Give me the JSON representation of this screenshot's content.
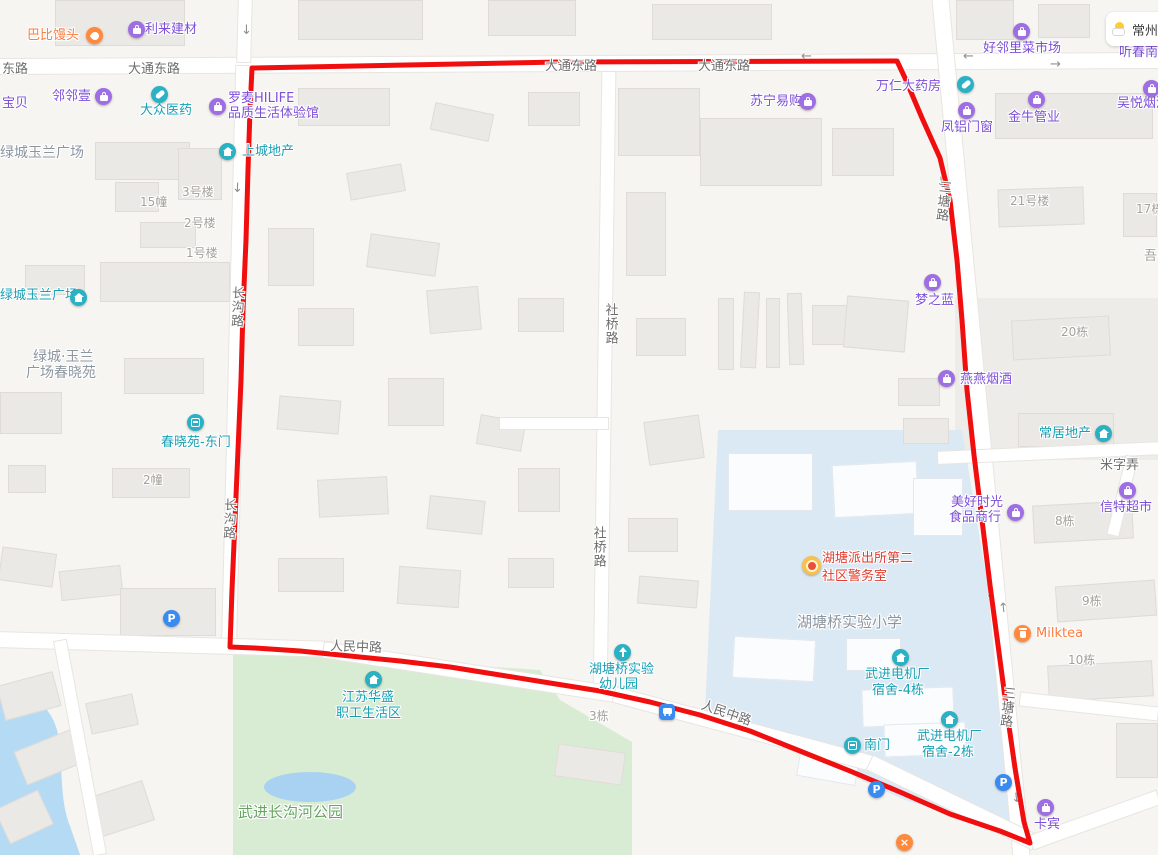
{
  "map": {
    "width": 1158,
    "height": 855
  },
  "colors": {
    "purple": "#7C4FD8",
    "teal": "#17A0B4",
    "orange": "#FF7B3D",
    "red_text": "#E23B2E",
    "gray_label": "#A5A099",
    "area_label": "#8C96A0",
    "green_label": "#67A463",
    "road_label": "#6E6E6E",
    "route_red": "#F10E0E",
    "school_fill": "#DBE9F4",
    "park_fill": "#D8ECD3",
    "water_fill": "#B5DAF4"
  },
  "weather": {
    "city": "常州"
  },
  "route": {
    "color": "#F10E0E",
    "width": 5,
    "points": "252,68 560,62 897,61 905,78 922,118 940,158 950,200 957,260 962,320 967,390 974,455 982,520 990,585 998,645 1006,705 1015,768 1024,822 1030,843 1000,831 950,814 900,792 850,771 800,751 750,731 700,715 650,702 600,691 550,683 500,675 450,667 400,661 350,656 300,651 255,648 230,647 232,590 235,520 238,450 241,380 243,310 246,240 248,170 250,110 252,68"
  },
  "areas": {
    "school": "M718,430 L962,430 L985,570 L1000,680 L1015,790 L1022,836 L905,800 L790,748 L705,712 L712,560 Z",
    "park": "M233,650 L540,670 L560,700 L632,742 L632,855 L233,855 Z",
    "river": "M0,686 C28,690 50,704 57,730 C64,758 58,796 70,826 C74,838 78,848 80,855 L0,855 Z",
    "pond": {
      "cx": 310,
      "cy": 787,
      "rx": 46,
      "ry": 15
    }
  },
  "parcels": [
    [
      955,
      298,
      205,
      162
    ]
  ],
  "roads": [
    [
      -4,
      56,
      1166,
      15,
      -0.3
    ],
    [
      238,
      0,
      13,
      62,
      1.5
    ],
    [
      229,
      66,
      14,
      588,
      1.4
    ],
    [
      598,
      72,
      13,
      622,
      0.8
    ],
    [
      973,
      -6,
      16,
      868,
      -5.4
    ],
    [
      -4,
      637,
      340,
      15,
      1.7
    ],
    [
      322,
      665,
      300,
      15,
      8.7
    ],
    [
      610,
      722,
      270,
      15,
      15
    ],
    [
      861,
      795,
      183,
      15,
      25.9
    ],
    [
      1028,
      813,
      134,
      14,
      -19.7
    ],
    [
      938,
      447,
      222,
      12,
      -2.5
    ],
    [
      1117,
      456,
      11,
      80,
      13.9
    ],
    [
      74,
      639,
      12,
      217,
      -10.6
    ],
    [
      1020,
      700,
      138,
      13,
      6.2
    ],
    [
      500,
      418,
      108,
      11,
      0
    ]
  ],
  "buildings": [
    [
      55,
      0,
      130,
      46,
      0,
      0
    ],
    [
      298,
      0,
      125,
      40,
      0,
      0
    ],
    [
      488,
      0,
      88,
      36,
      0,
      0
    ],
    [
      652,
      4,
      120,
      36,
      0,
      0
    ],
    [
      956,
      0,
      58,
      40,
      0,
      0
    ],
    [
      1038,
      4,
      52,
      34,
      0,
      0
    ],
    [
      95,
      142,
      95,
      38,
      0,
      0
    ],
    [
      178,
      148,
      44,
      52,
      0,
      0
    ],
    [
      115,
      182,
      44,
      30,
      0,
      0
    ],
    [
      140,
      222,
      56,
      26,
      0,
      0
    ],
    [
      100,
      262,
      130,
      40,
      0,
      0
    ],
    [
      25,
      265,
      60,
      30,
      0,
      0
    ],
    [
      0,
      392,
      62,
      42,
      0,
      0
    ],
    [
      124,
      358,
      80,
      36,
      0,
      0
    ],
    [
      8,
      465,
      38,
      28,
      0,
      0
    ],
    [
      112,
      468,
      78,
      30,
      0,
      0
    ],
    [
      0,
      550,
      55,
      34,
      8,
      0
    ],
    [
      60,
      568,
      62,
      30,
      -6,
      0
    ],
    [
      120,
      588,
      96,
      48,
      0,
      0
    ],
    [
      298,
      88,
      92,
      38,
      0,
      0
    ],
    [
      432,
      108,
      60,
      28,
      12,
      0
    ],
    [
      528,
      92,
      52,
      34,
      0,
      0
    ],
    [
      348,
      168,
      56,
      28,
      -10,
      0
    ],
    [
      268,
      228,
      46,
      58,
      0,
      0
    ],
    [
      368,
      238,
      70,
      34,
      8,
      0
    ],
    [
      298,
      308,
      56,
      38,
      0,
      0
    ],
    [
      428,
      288,
      52,
      44,
      -5,
      0
    ],
    [
      518,
      298,
      46,
      34,
      0,
      0
    ],
    [
      278,
      398,
      62,
      34,
      5,
      0
    ],
    [
      388,
      378,
      56,
      48,
      0,
      0
    ],
    [
      478,
      418,
      46,
      30,
      10,
      0
    ],
    [
      318,
      478,
      70,
      38,
      -3,
      0
    ],
    [
      428,
      498,
      56,
      34,
      6,
      0
    ],
    [
      518,
      468,
      42,
      44,
      0,
      0
    ],
    [
      278,
      558,
      66,
      34,
      0,
      0
    ],
    [
      398,
      568,
      62,
      38,
      4,
      0
    ],
    [
      508,
      558,
      46,
      30,
      0,
      0
    ],
    [
      618,
      88,
      82,
      68,
      0,
      0
    ],
    [
      626,
      192,
      40,
      84,
      0,
      0
    ],
    [
      636,
      318,
      50,
      38,
      0,
      0
    ],
    [
      646,
      418,
      56,
      44,
      -8,
      0
    ],
    [
      628,
      518,
      50,
      34,
      0,
      0
    ],
    [
      638,
      578,
      60,
      28,
      5,
      0
    ],
    [
      700,
      118,
      122,
      68,
      0,
      0
    ],
    [
      832,
      128,
      62,
      48,
      0,
      0
    ],
    [
      718,
      298,
      16,
      72,
      0,
      0
    ],
    [
      742,
      292,
      16,
      76,
      3,
      0
    ],
    [
      766,
      298,
      14,
      70,
      0,
      0
    ],
    [
      788,
      293,
      15,
      72,
      -2,
      0
    ],
    [
      812,
      305,
      55,
      40,
      0,
      0
    ],
    [
      845,
      298,
      62,
      52,
      5,
      0
    ],
    [
      995,
      93,
      158,
      46,
      0,
      0
    ],
    [
      998,
      188,
      86,
      38,
      -2,
      0
    ],
    [
      1123,
      193,
      34,
      44,
      0,
      0
    ],
    [
      1012,
      318,
      98,
      40,
      -3,
      0
    ],
    [
      898,
      378,
      42,
      28,
      0,
      0
    ],
    [
      903,
      418,
      46,
      26,
      0,
      0
    ],
    [
      1018,
      413,
      96,
      34,
      0,
      0
    ],
    [
      1033,
      503,
      100,
      38,
      -3,
      0
    ],
    [
      1056,
      583,
      100,
      36,
      -4,
      0
    ],
    [
      1048,
      663,
      105,
      36,
      -3,
      0
    ],
    [
      1116,
      723,
      42,
      55,
      0,
      0
    ],
    [
      728,
      453,
      85,
      58,
      0,
      1
    ],
    [
      833,
      463,
      85,
      53,
      -3,
      1
    ],
    [
      913,
      478,
      50,
      58,
      0,
      1
    ],
    [
      733,
      638,
      82,
      42,
      3,
      1
    ],
    [
      846,
      638,
      55,
      33,
      0,
      1
    ],
    [
      862,
      688,
      92,
      38,
      -2,
      1
    ],
    [
      884,
      723,
      82,
      33,
      -2,
      1
    ],
    [
      798,
      753,
      60,
      28,
      10,
      1
    ],
    [
      0,
      678,
      58,
      36,
      -15,
      0
    ],
    [
      18,
      738,
      68,
      36,
      -22,
      0
    ],
    [
      88,
      698,
      48,
      32,
      -12,
      0
    ],
    [
      0,
      798,
      48,
      38,
      -25,
      0
    ],
    [
      92,
      788,
      58,
      42,
      -18,
      0
    ],
    [
      556,
      748,
      68,
      33,
      8,
      0
    ]
  ],
  "arrows": [
    {
      "x": 241,
      "y": 24,
      "g": "↓",
      "r": 0
    },
    {
      "x": 963,
      "y": 50,
      "g": "←",
      "r": 0
    },
    {
      "x": 1050,
      "y": 58,
      "g": "→",
      "r": 0
    },
    {
      "x": 801,
      "y": 50,
      "g": "←",
      "r": 0
    },
    {
      "x": 232,
      "y": 182,
      "g": "↓",
      "r": 2
    },
    {
      "x": 936,
      "y": 176,
      "g": "↓",
      "r": -6
    },
    {
      "x": 985,
      "y": 588,
      "g": "↓",
      "r": -5
    },
    {
      "x": 998,
      "y": 602,
      "g": "↑",
      "r": -5
    },
    {
      "x": 1011,
      "y": 792,
      "g": "↓",
      "r": -6
    }
  ],
  "labels": [
    {
      "t": "东路",
      "x": 2,
      "y": 62,
      "c": "road"
    },
    {
      "t": "大通东路",
      "x": 128,
      "y": 62,
      "c": "road"
    },
    {
      "t": "大通东路",
      "x": 545,
      "y": 59,
      "c": "road"
    },
    {
      "t": "大通东路",
      "x": 698,
      "y": 59,
      "c": "road"
    },
    {
      "t": "长沟路",
      "x": 228,
      "y": 286,
      "c": "road",
      "v": 1,
      "r": 2
    },
    {
      "t": "长沟路",
      "x": 220,
      "y": 498,
      "c": "road",
      "v": 1,
      "r": 2
    },
    {
      "t": "社桥路",
      "x": 602,
      "y": 303,
      "c": "road",
      "v": 1
    },
    {
      "t": "社桥路",
      "x": 590,
      "y": 526,
      "c": "road",
      "v": 1
    },
    {
      "t": "三塘路",
      "x": 934,
      "y": 180,
      "c": "road",
      "v": 1,
      "r": 6
    },
    {
      "t": "三塘路",
      "x": 998,
      "y": 686,
      "c": "road",
      "v": 1,
      "r": 6
    },
    {
      "t": "人民中路",
      "x": 330,
      "y": 640,
      "c": "road",
      "r": 2
    },
    {
      "t": "人民中路",
      "x": 700,
      "y": 706,
      "c": "road",
      "r": 19
    },
    {
      "t": "米字弄",
      "x": 1100,
      "y": 458,
      "c": "road"
    },
    {
      "t": "3号楼",
      "x": 182,
      "y": 185,
      "c": "bldg",
      "s": 12
    },
    {
      "t": "15幢",
      "x": 140,
      "y": 195,
      "c": "bldg",
      "s": 12
    },
    {
      "t": "2号楼",
      "x": 184,
      "y": 216,
      "c": "bldg",
      "s": 12
    },
    {
      "t": "1号楼",
      "x": 186,
      "y": 246,
      "c": "bldg",
      "s": 12
    },
    {
      "t": "2幢",
      "x": 143,
      "y": 473,
      "c": "bldg",
      "s": 12
    },
    {
      "t": "21号楼",
      "x": 1010,
      "y": 194,
      "c": "bldg",
      "s": 12
    },
    {
      "t": "17栋",
      "x": 1136,
      "y": 202,
      "c": "bldg",
      "s": 12
    },
    {
      "t": "吾",
      "x": 1144,
      "y": 249,
      "c": "bldg",
      "s": 13
    },
    {
      "t": "20栋",
      "x": 1061,
      "y": 325,
      "c": "bldg",
      "s": 12
    },
    {
      "t": "8栋",
      "x": 1055,
      "y": 514,
      "c": "bldg",
      "s": 12
    },
    {
      "t": "9栋",
      "x": 1082,
      "y": 594,
      "c": "bldg",
      "s": 12
    },
    {
      "t": "10栋",
      "x": 1068,
      "y": 653,
      "c": "bldg",
      "s": 12
    },
    {
      "t": "3栋",
      "x": 589,
      "y": 709,
      "c": "bldg",
      "s": 12
    },
    {
      "t": "绿城玉兰广场",
      "x": 0,
      "y": 145,
      "c": "area",
      "s": 14
    },
    {
      "t": "绿城·玉兰",
      "x": 33,
      "y": 349,
      "c": "area",
      "s": 14
    },
    {
      "t": "广场春晓苑",
      "x": 26,
      "y": 365,
      "c": "area",
      "s": 14
    },
    {
      "t": "湖塘桥实验小学",
      "x": 797,
      "y": 613,
      "c": "area",
      "s": 15
    },
    {
      "t": "武进长沟河公园",
      "x": 238,
      "y": 803,
      "c": "park",
      "s": 15
    },
    {
      "t": "宝贝",
      "x": 2,
      "y": 96,
      "c": "purple",
      "i": 1
    },
    {
      "t": "邻邻壹",
      "x": 52,
      "y": 89,
      "c": "purple",
      "i": 1
    },
    {
      "t": "利来建材",
      "x": 145,
      "y": 22,
      "c": "purple",
      "i": 1
    },
    {
      "t": "罗麦HILIFE",
      "x": 228,
      "y": 91,
      "c": "purple",
      "i": 1
    },
    {
      "t": "品质生活体验馆",
      "x": 228,
      "y": 106,
      "c": "purple",
      "i": 1
    },
    {
      "t": "苏宁易购",
      "x": 750,
      "y": 94,
      "c": "purple",
      "i": 1
    },
    {
      "t": "万仁大药房",
      "x": 876,
      "y": 79,
      "c": "purple",
      "i": 1
    },
    {
      "t": "好邻里菜市场",
      "x": 983,
      "y": 41,
      "c": "purple",
      "i": 1
    },
    {
      "t": "金牛管业",
      "x": 1008,
      "y": 110,
      "c": "purple",
      "i": 1
    },
    {
      "t": "吴悦烟酒",
      "x": 1117,
      "y": 96,
      "c": "purple",
      "i": 1
    },
    {
      "t": "凤铝门窗",
      "x": 941,
      "y": 120,
      "c": "purple",
      "i": 1
    },
    {
      "t": "听春南",
      "x": 1119,
      "y": 45,
      "c": "purple",
      "i": 1
    },
    {
      "t": "梦之蓝",
      "x": 915,
      "y": 293,
      "c": "purple",
      "i": 1
    },
    {
      "t": "燕燕烟酒",
      "x": 960,
      "y": 372,
      "c": "purple",
      "i": 1
    },
    {
      "t": "美好时光",
      "x": 951,
      "y": 495,
      "c": "purple",
      "i": 1
    },
    {
      "t": "食品商行",
      "x": 949,
      "y": 510,
      "c": "purple",
      "i": 1
    },
    {
      "t": "信特超市",
      "x": 1100,
      "y": 500,
      "c": "purple",
      "i": 1
    },
    {
      "t": "卡宾",
      "x": 1034,
      "y": 817,
      "c": "purple",
      "i": 1
    },
    {
      "t": "巴比馒头",
      "x": 27,
      "y": 28,
      "c": "orange",
      "i": 1
    },
    {
      "t": "Milktea",
      "x": 1036,
      "y": 626,
      "c": "orange",
      "i": 1
    },
    {
      "t": "湖塘派出所第二",
      "x": 822,
      "y": 551,
      "c": "red",
      "i": 1
    },
    {
      "t": "社区警务室",
      "x": 822,
      "y": 569,
      "c": "red",
      "i": 1
    },
    {
      "t": "大众医药",
      "x": 140,
      "y": 103,
      "c": "teal",
      "i": 1
    },
    {
      "t": "上城地产",
      "x": 242,
      "y": 144,
      "c": "teal",
      "i": 1
    },
    {
      "t": "绿城玉兰广场",
      "x": 0,
      "y": 288,
      "c": "teal",
      "i": 1
    },
    {
      "t": "春晓苑-东门",
      "x": 161,
      "y": 435,
      "c": "teal",
      "i": 1
    },
    {
      "t": "常居地产",
      "x": 1039,
      "y": 426,
      "c": "teal",
      "i": 1
    },
    {
      "t": "江苏华盛",
      "x": 342,
      "y": 690,
      "c": "teal",
      "i": 1
    },
    {
      "t": "职工生活区",
      "x": 336,
      "y": 706,
      "c": "teal",
      "i": 1
    },
    {
      "t": "湖塘桥实验",
      "x": 589,
      "y": 662,
      "c": "teal",
      "i": 1
    },
    {
      "t": "幼儿园",
      "x": 599,
      "y": 677,
      "c": "teal",
      "i": 1
    },
    {
      "t": "南门",
      "x": 864,
      "y": 738,
      "c": "teal",
      "i": 1
    },
    {
      "t": "武进电机厂",
      "x": 865,
      "y": 667,
      "c": "teal",
      "i": 1
    },
    {
      "t": "宿舍-4栋",
      "x": 872,
      "y": 683,
      "c": "teal",
      "i": 1
    },
    {
      "t": "武进电机厂",
      "x": 917,
      "y": 729,
      "c": "teal",
      "i": 1
    },
    {
      "t": "宿舍-2栋",
      "x": 922,
      "y": 745,
      "c": "teal",
      "i": 1
    }
  ],
  "icons": [
    {
      "k": "hand",
      "x": 86,
      "y": 27,
      "n": "baozi-shop-icon"
    },
    {
      "k": "bag",
      "x": 128,
      "y": 21,
      "n": "shop-bag-icon"
    },
    {
      "k": "bag",
      "x": 95,
      "y": 88,
      "n": "shop-bag-icon"
    },
    {
      "k": "pill",
      "x": 151,
      "y": 86,
      "n": "pharmacy-icon"
    },
    {
      "k": "bag",
      "x": 209,
      "y": 98,
      "n": "shop-bag-icon"
    },
    {
      "k": "house",
      "x": 219,
      "y": 143,
      "n": "real-estate-icon"
    },
    {
      "k": "bag",
      "x": 799,
      "y": 93,
      "n": "shop-bag-icon"
    },
    {
      "k": "pill",
      "x": 957,
      "y": 76,
      "n": "pharmacy-icon"
    },
    {
      "k": "bag",
      "x": 1013,
      "y": 23,
      "n": "market-icon"
    },
    {
      "k": "bag",
      "x": 1028,
      "y": 91,
      "n": "shop-bag-icon"
    },
    {
      "k": "bag",
      "x": 1143,
      "y": 80,
      "n": "shop-bag-icon"
    },
    {
      "k": "bag",
      "x": 958,
      "y": 102,
      "n": "shop-bag-icon"
    },
    {
      "k": "house",
      "x": 70,
      "y": 289,
      "n": "residence-icon"
    },
    {
      "k": "bag",
      "x": 924,
      "y": 274,
      "n": "shop-bag-icon"
    },
    {
      "k": "gate",
      "x": 187,
      "y": 414,
      "n": "east-gate-icon"
    },
    {
      "k": "bag",
      "x": 938,
      "y": 370,
      "n": "shop-bag-icon"
    },
    {
      "k": "house",
      "x": 1095,
      "y": 425,
      "n": "real-estate-icon"
    },
    {
      "k": "bag",
      "x": 1007,
      "y": 504,
      "n": "shop-bag-icon"
    },
    {
      "k": "bag",
      "x": 1119,
      "y": 482,
      "n": "supermarket-icon"
    },
    {
      "k": "cup",
      "x": 1014,
      "y": 625,
      "n": "milktea-icon"
    },
    {
      "k": "police",
      "x": 802,
      "y": 556,
      "n": "police-badge-icon"
    },
    {
      "k": "P",
      "x": 163,
      "y": 610,
      "n": "parking-icon"
    },
    {
      "k": "P",
      "x": 868,
      "y": 781,
      "n": "parking-icon"
    },
    {
      "k": "P",
      "x": 995,
      "y": 774,
      "n": "parking-icon"
    },
    {
      "k": "bus",
      "x": 659,
      "y": 704,
      "n": "bus-stop-icon"
    },
    {
      "k": "house",
      "x": 365,
      "y": 671,
      "n": "residence-icon"
    },
    {
      "k": "tree",
      "x": 614,
      "y": 644,
      "n": "kindergarten-icon"
    },
    {
      "k": "gate",
      "x": 844,
      "y": 737,
      "n": "south-gate-icon"
    },
    {
      "k": "house",
      "x": 892,
      "y": 649,
      "n": "residence-icon"
    },
    {
      "k": "house",
      "x": 941,
      "y": 711,
      "n": "residence-icon"
    },
    {
      "k": "x",
      "x": 896,
      "y": 834,
      "n": "restaurant-icon"
    },
    {
      "k": "bag",
      "x": 1037,
      "y": 799,
      "n": "shop-bag-icon"
    }
  ]
}
